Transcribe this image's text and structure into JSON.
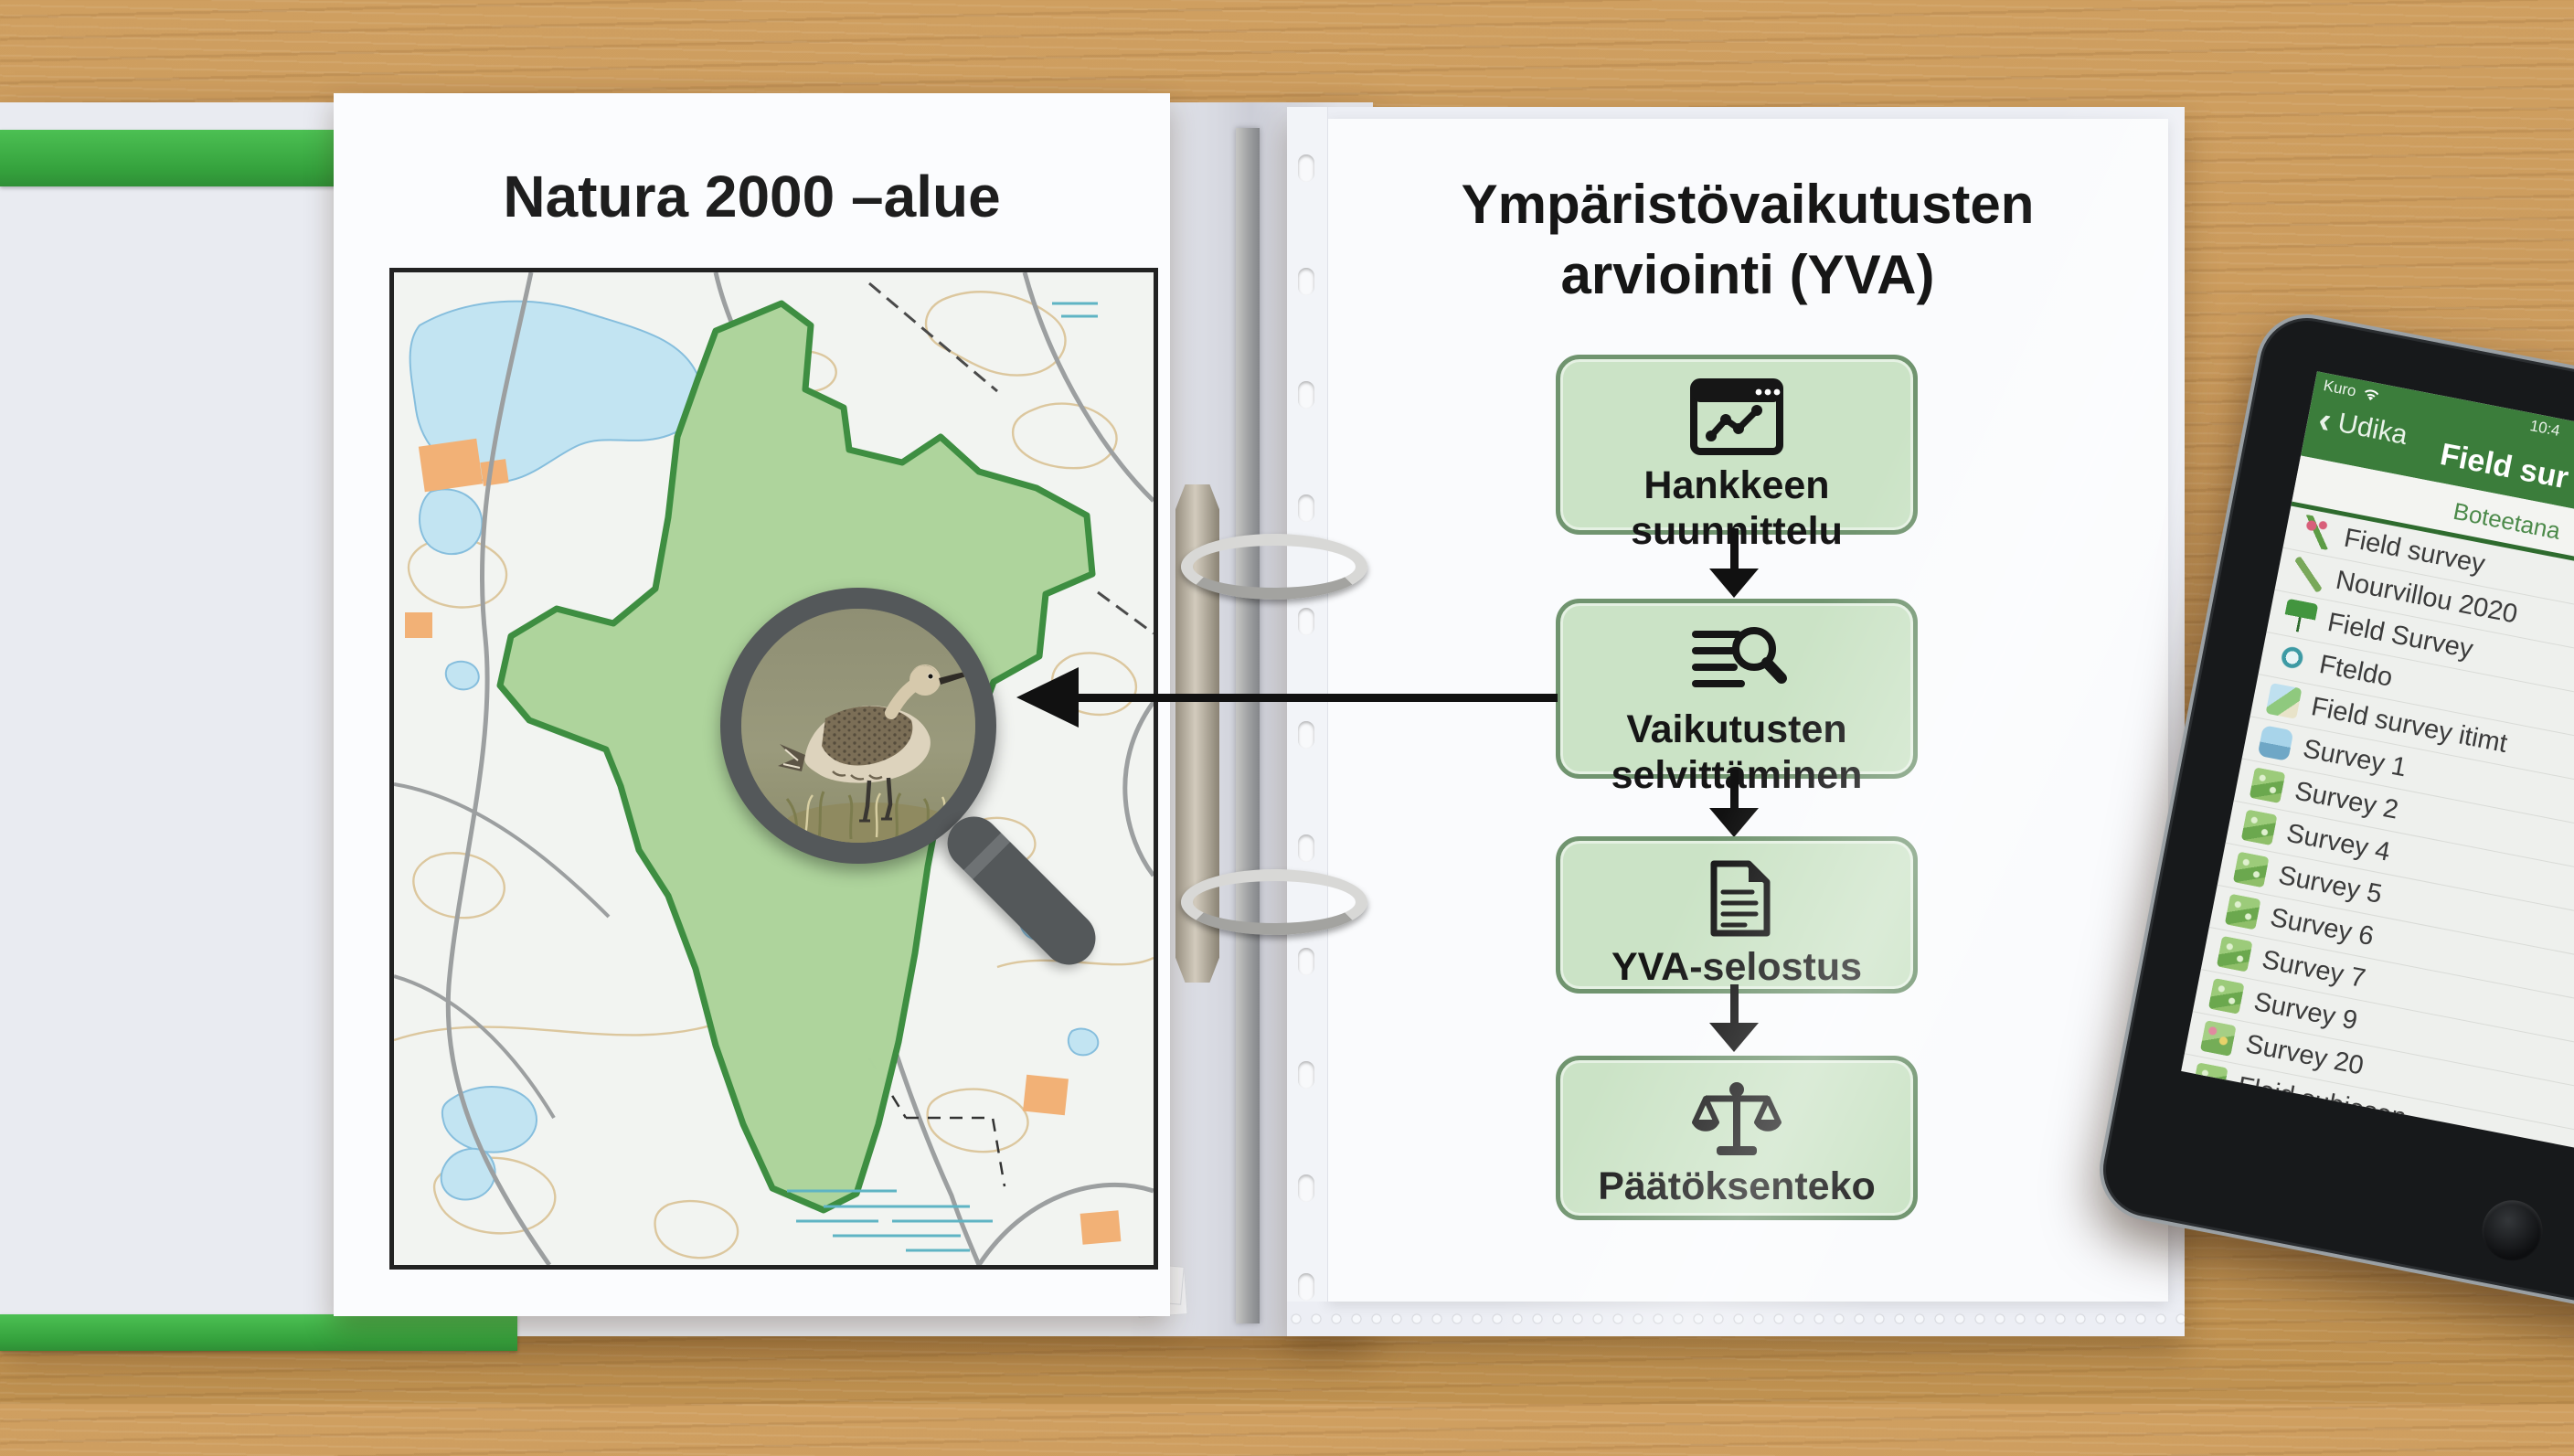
{
  "colors": {
    "binder_green": "#3fae46",
    "flow_box_fill": "#cbe3c6",
    "flow_box_border": "#70946f",
    "natura_fill": "#aed49c",
    "natura_border": "#3e8e41",
    "tablet_header_green": "#3b7d3b",
    "arrow_black": "#111111"
  },
  "left_page": {
    "title": "Natura 2000 –alue",
    "map_icons": [
      "protected-area-polygon",
      "lake",
      "pond",
      "road",
      "contour-lines",
      "marsh-hatch",
      "buildings"
    ]
  },
  "magnifier": {
    "icon": "magnifier-bird-photo",
    "subject": "wading bird standing in grass"
  },
  "right_page": {
    "title": "Ympäristövaikutusten arviointi (YVA)"
  },
  "flow": {
    "steps": [
      {
        "icon": "chart-window-icon",
        "label": "Hankkeen\nsuunnittelu"
      },
      {
        "icon": "search-list-icon",
        "label": "Vaikutusten\nselvittäminen"
      },
      {
        "icon": "document-icon",
        "label": "YVA-selostus"
      },
      {
        "icon": "scales-icon",
        "label": "Päätöksenteko"
      }
    ]
  },
  "tablet": {
    "status_left": "Kuro",
    "status_icon": "wifi-icon",
    "time": "10:4",
    "back_label": "Udika",
    "app_title": "Field sur",
    "tab_label": "Boteetana",
    "rows": [
      {
        "icon": "flower-icon",
        "label": "Field survey"
      },
      {
        "icon": "pencil-icon",
        "label": "Nourvillou 2020"
      },
      {
        "icon": "flag-icon",
        "label": "Field Survey"
      },
      {
        "icon": "globe-icon",
        "label": "Fteldo"
      },
      {
        "icon": "map-photos-icon",
        "label": "Field survey itimt"
      },
      {
        "icon": "boat-icon",
        "label": "Survey 1"
      },
      {
        "icon": "plant-icon",
        "label": "Survey 2"
      },
      {
        "icon": "plant-icon",
        "label": "Survey 4"
      },
      {
        "icon": "plant-icon",
        "label": "Survey 5"
      },
      {
        "icon": "plant-icon",
        "label": "Survey 6"
      },
      {
        "icon": "plant-icon",
        "label": "Survey 7"
      },
      {
        "icon": "plant-icon",
        "label": "Survey 9"
      },
      {
        "icon": "flowers-icon",
        "label": "Survey 20"
      },
      {
        "icon": "plant-icon",
        "label": "Fleid subiesen"
      }
    ]
  }
}
